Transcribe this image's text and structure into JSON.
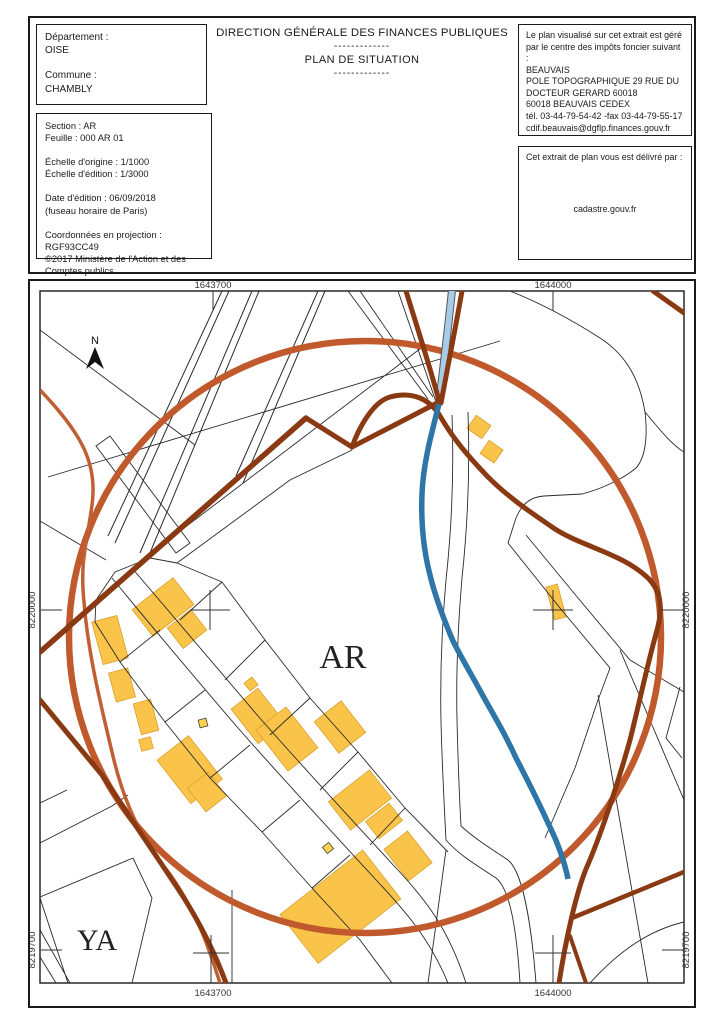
{
  "header": {
    "dept": {
      "label": "Département :",
      "value": "OISE"
    },
    "commune": {
      "label": "Commune :",
      "value": "CHAMBLY"
    },
    "title": "DIRECTION GÉNÉRALE DES FINANCES PUBLIQUES",
    "separator": "-------------",
    "subtitle": "PLAN DE SITUATION",
    "info_block": "Section : AR\nFeuille : 000 AR 01\n\nÉchelle d'origine : 1/1000\nÉchelle d'édition : 1/3000\n\nDate d'édition : 06/09/2018\n(fuseau horaire de Paris)\n\nCoordonnées en projection : RGF93CC49\n©2017 Ministère de l'Action et des\nComptes publics",
    "tax_office_block": "Le plan visualisé sur cet extrait est géré\npar le centre des impôts foncier suivant :\nBEAUVAIS\nPOLE TOPOGRAPHIQUE 29 RUE DU\nDOCTEUR GERARD 60018\n60018 BEAUVAIS CEDEX\ntél. 03-44-79-54-42 -fax 03-44-79-55-17\ncdif.beauvais@dgflp.finances.gouv.fr",
    "delivery": {
      "label": "Cet extrait de plan vous est délivré par :",
      "value": "cadastre.gouv.fr"
    }
  },
  "map": {
    "coords": {
      "top_left": "1643700",
      "top_right": "1644000",
      "bottom_left": "1643700",
      "bottom_right": "1644000",
      "left_mid": "8220000",
      "right_mid": "8220000",
      "left_bottom": "8219700",
      "right_bottom": "8219700"
    },
    "labels": {
      "section": "AR",
      "section_sw": "YA",
      "north": "N"
    },
    "colors": {
      "highlight_circle": "#c05a2c",
      "road_orange": "#bf5f33",
      "road_dark_brown": "#8a3a12",
      "water_light": "#a8cce8",
      "water_dark": "#2f76a8",
      "building_fill": "#fac44a",
      "building_stroke": "#d69a25",
      "parcel_line": "#2a2a2a"
    }
  }
}
